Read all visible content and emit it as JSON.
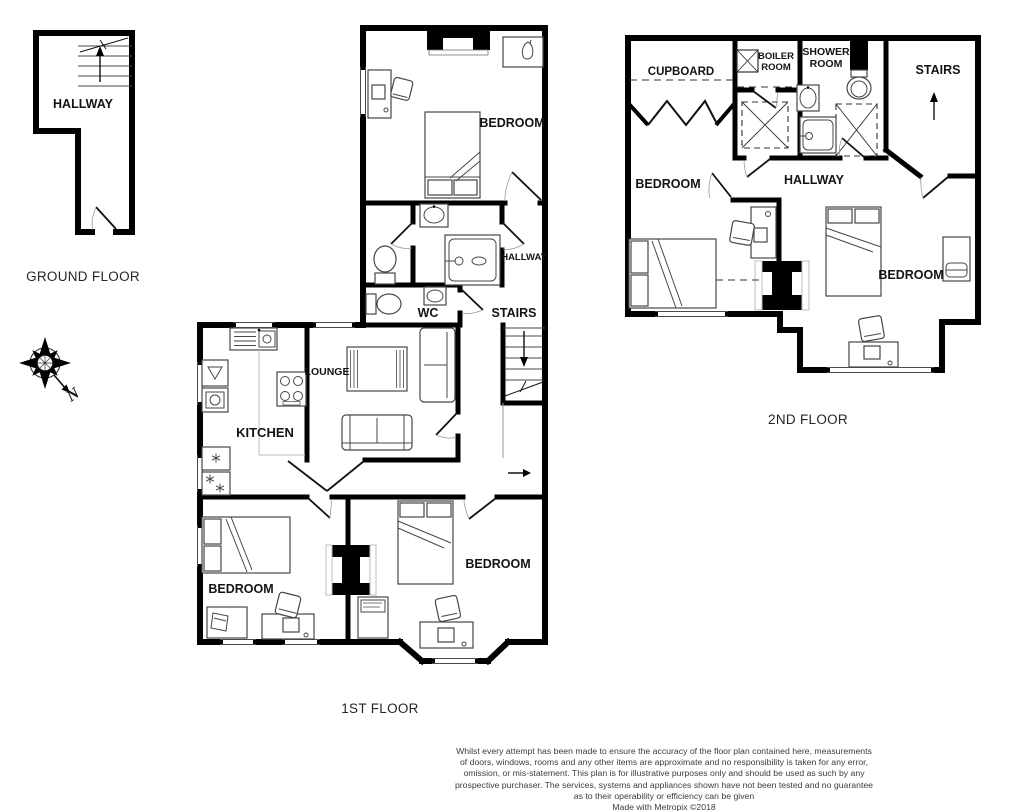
{
  "colors": {
    "wall": "#000000",
    "furniture": "#474747",
    "label_text": "#141414",
    "title_text": "#262626",
    "disclaimer_text": "#3c3c3c"
  },
  "ground_floor": {
    "title": "GROUND FLOOR",
    "hallway_label": "HALLWAY"
  },
  "first_floor": {
    "title": "1ST FLOOR",
    "bedroom_top_label": "BEDROOM",
    "hallway_label": "HALLWAY",
    "wc_label": "WC",
    "stairs_label": "STAIRS",
    "lounge_label": "LOUNGE",
    "kitchen_label": "KITCHEN",
    "bedroom_left_label": "BEDROOM",
    "bedroom_right_label": "BEDROOM"
  },
  "second_floor": {
    "title": "2ND FLOOR",
    "cupboard_label": "CUPBOARD",
    "boiler_room_label_line1": "BOILER",
    "boiler_room_label_line2": "ROOM",
    "shower_room_label_line1": "SHOWER",
    "shower_room_label_line2": "ROOM",
    "stairs_label": "STAIRS",
    "bedroom_left_label": "BEDROOM",
    "hallway_label": "HALLWAY",
    "bedroom_right_label": "BEDROOM"
  },
  "compass": {
    "north_label": "N"
  },
  "disclaimer": {
    "line1": "Whilst every attempt has been made to ensure the accuracy of the floor plan contained here, measurements",
    "line2": "of doors, windows, rooms and any other items are approximate and no responsibility is taken for any error,",
    "line3": "omission, or mis-statement. This plan is for illustrative purposes only and should be used as such by any",
    "line4": "prospective purchaser. The services, systems and appliances shown have not been tested and no guarantee",
    "line5": "as to their operability or efficiency can be given",
    "credit": "Made with Metropix ©2018"
  }
}
